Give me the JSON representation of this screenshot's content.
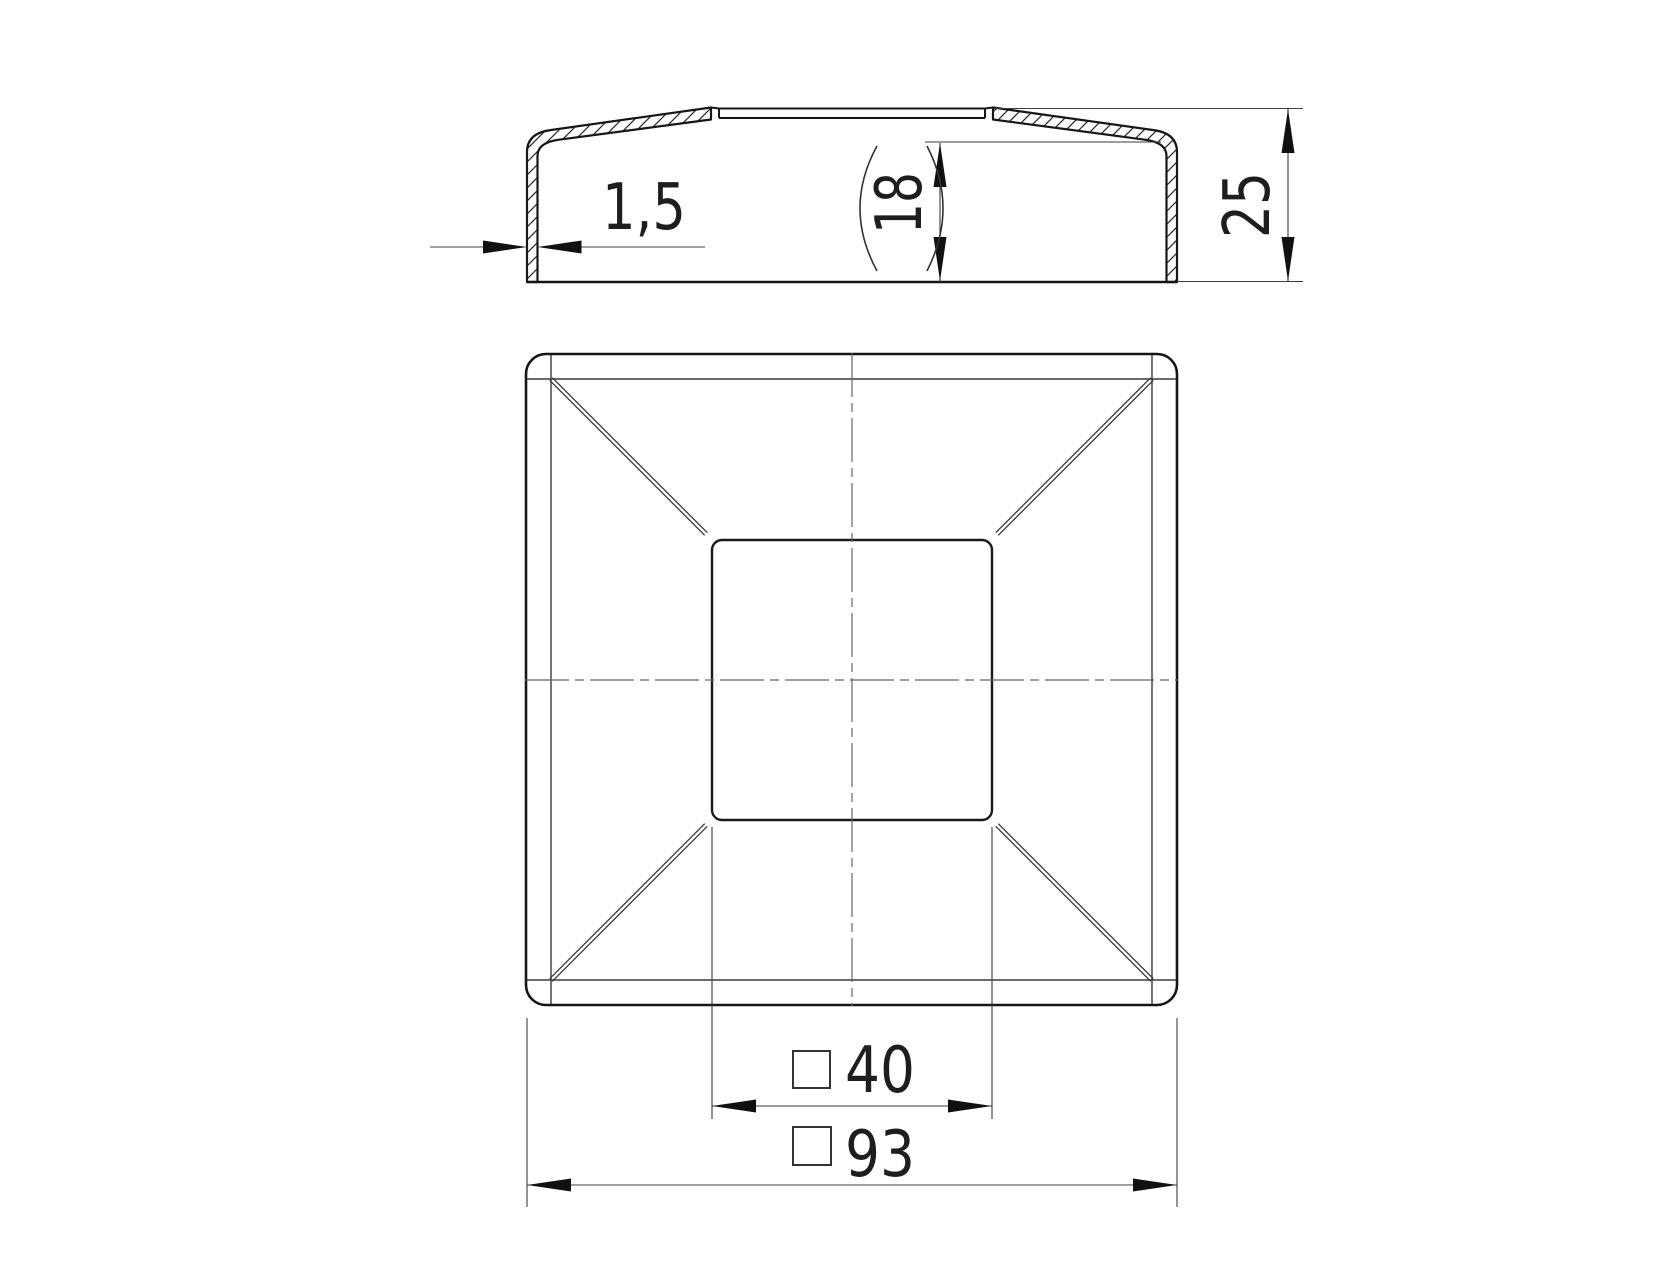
{
  "page": {
    "background": "#ffffff",
    "ink": "#1a1a1a",
    "thin_line": "#3d3d3d",
    "centerline_color": "#666666"
  },
  "drawing": {
    "type": "technical-drawing-2-views",
    "views": [
      {
        "id": "section",
        "description": "side section view of square cap, hatched cut walls"
      },
      {
        "id": "plan",
        "description": "plan view of square cap with central square plateau and corner fold diagonals"
      }
    ],
    "dimensions": {
      "wall_thickness": {
        "label": "1,5"
      },
      "inner_height": {
        "label": "18",
        "reference_parentheses": true
      },
      "overall_height": {
        "label": "25"
      },
      "inner_square": {
        "label": "40",
        "prefix_symbol": "square"
      },
      "outer_square": {
        "label": "93",
        "prefix_symbol": "square"
      }
    }
  }
}
